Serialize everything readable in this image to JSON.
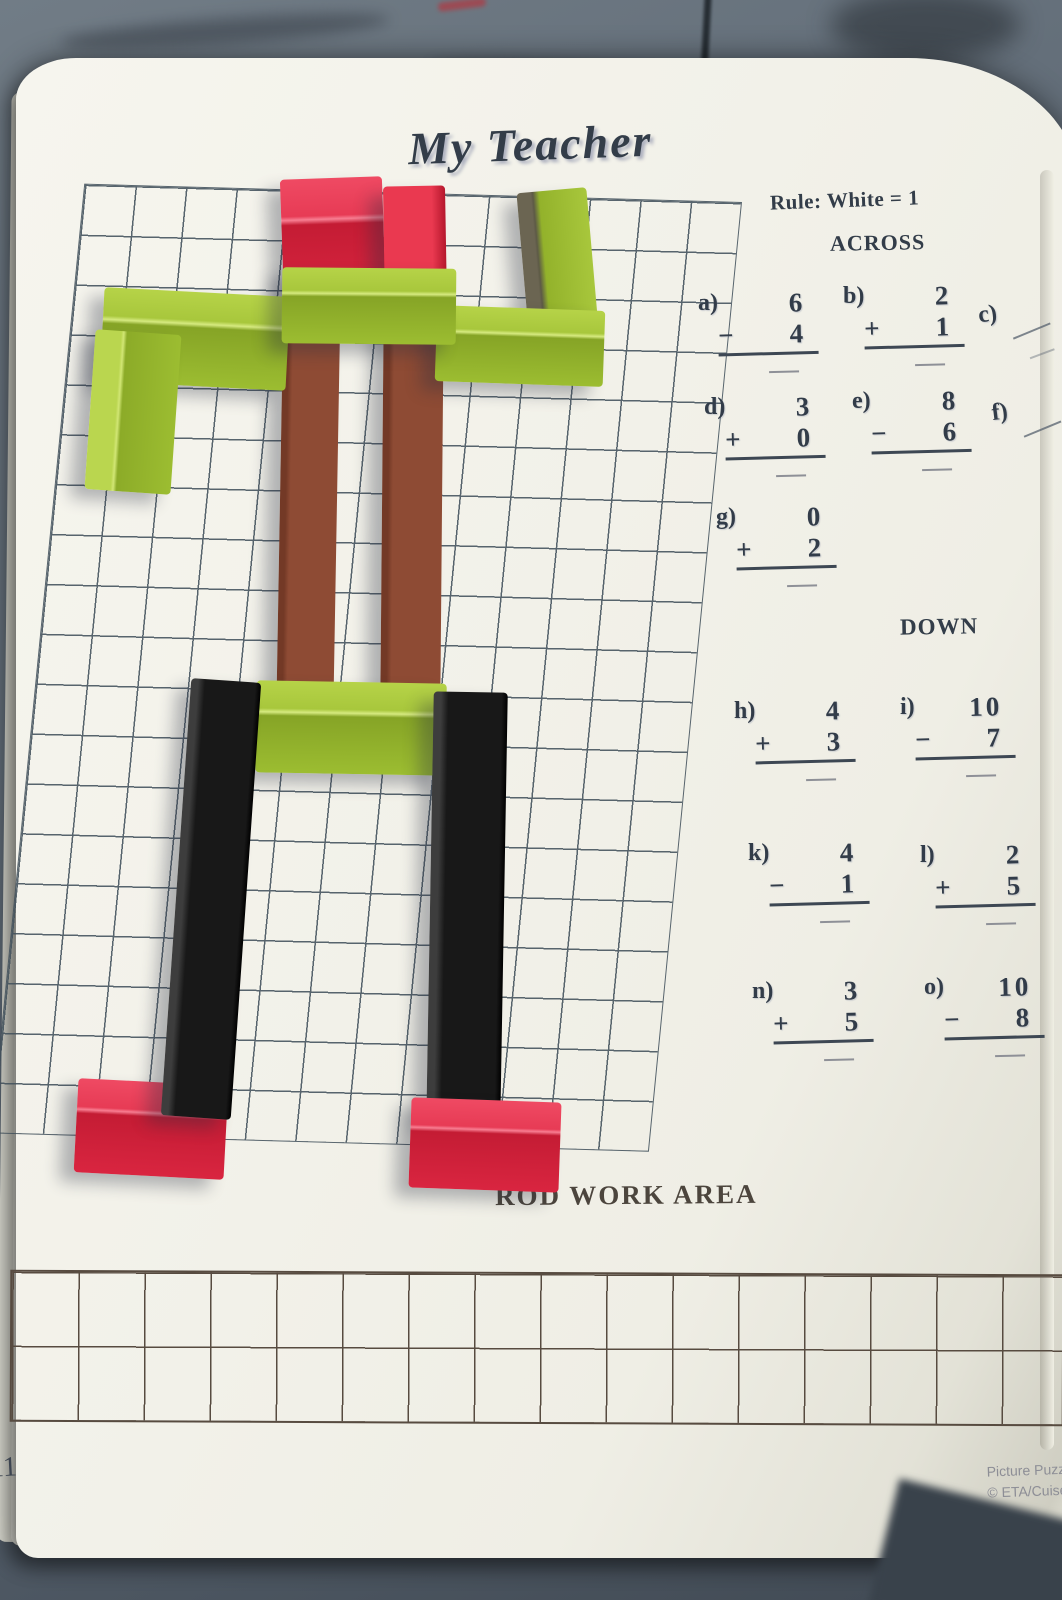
{
  "page": {
    "title": "My Teacher",
    "rule": "Rule: White = 1",
    "across_heading": "ACROSS",
    "down_heading": "DOWN",
    "rod_work_area_label": "ROD WORK AREA",
    "page_number": "11",
    "credit_line1": "Picture Puzzle",
    "credit_line2": "© ETA/Cuisen"
  },
  "problems": [
    {
      "id": "a",
      "label": "a)",
      "top": "6",
      "op": "−",
      "bottom": "4"
    },
    {
      "id": "b",
      "label": "b)",
      "top": "2",
      "op": "+",
      "bottom": "1"
    },
    {
      "id": "c",
      "label": "c)",
      "top": "",
      "op": "",
      "bottom": ""
    },
    {
      "id": "d",
      "label": "d)",
      "top": "3",
      "op": "+",
      "bottom": "0"
    },
    {
      "id": "e",
      "label": "e)",
      "top": "8",
      "op": "−",
      "bottom": "6"
    },
    {
      "id": "f",
      "label": "f)",
      "top": "",
      "op": "",
      "bottom": ""
    },
    {
      "id": "g",
      "label": "g)",
      "top": "0",
      "op": "+",
      "bottom": "2"
    },
    {
      "id": "h",
      "label": "h)",
      "top": "4",
      "op": "+",
      "bottom": "3"
    },
    {
      "id": "i",
      "label": "i)",
      "top": "10",
      "op": "−",
      "bottom": "7"
    },
    {
      "id": "k",
      "label": "k)",
      "top": "4",
      "op": "−",
      "bottom": "1"
    },
    {
      "id": "l",
      "label": "l)",
      "top": "2",
      "op": "+",
      "bottom": "5"
    },
    {
      "id": "n",
      "label": "n)",
      "top": "3",
      "op": "+",
      "bottom": "5"
    },
    {
      "id": "o",
      "label": "o)",
      "top": "10",
      "op": "−",
      "bottom": "8"
    }
  ],
  "rods": [
    {
      "name": "rod-head-red-left",
      "style": "red-top",
      "x": 282,
      "y": 178,
      "w": 102,
      "h": 124,
      "rot": -2,
      "z": 3
    },
    {
      "name": "rod-head-red-right",
      "style": "red-plain",
      "x": 384,
      "y": 186,
      "w": 62,
      "h": 118,
      "rot": -1,
      "z": 3
    },
    {
      "name": "rod-left-upper-arm-green",
      "style": "green-top",
      "x": 102,
      "y": 292,
      "w": 186,
      "h": 94,
      "rot": 3,
      "z": 4
    },
    {
      "name": "rod-left-forearm-green",
      "style": "green-leftlight",
      "x": 90,
      "y": 332,
      "w": 86,
      "h": 160,
      "rot": 4,
      "z": 4
    },
    {
      "name": "rod-right-upper-arm-green",
      "style": "green-leftdark",
      "x": 522,
      "y": 190,
      "w": 70,
      "h": 130,
      "rot": -5,
      "z": 4
    },
    {
      "name": "rod-right-forearm-green",
      "style": "green-top",
      "x": 436,
      "y": 308,
      "w": 168,
      "h": 76,
      "rot": 2,
      "z": 4
    },
    {
      "name": "rod-torso-brown-left",
      "style": "brown-vert",
      "x": 280,
      "y": 308,
      "w": 57,
      "h": 384,
      "rot": 1,
      "z": 3
    },
    {
      "name": "rod-torso-brown-right",
      "style": "brown-vert",
      "x": 382,
      "y": 314,
      "w": 60,
      "h": 388,
      "rot": 0.5,
      "z": 3
    },
    {
      "name": "rod-shoulders-green",
      "style": "green-top",
      "x": 282,
      "y": 268,
      "w": 174,
      "h": 76,
      "rot": 0.5,
      "z": 5
    },
    {
      "name": "rod-hips-green",
      "style": "green-top",
      "x": 256,
      "y": 682,
      "w": 190,
      "h": 92,
      "rot": 1,
      "z": 4
    },
    {
      "name": "rod-left-leg-black",
      "style": "black-vert",
      "x": 176,
      "y": 680,
      "w": 70,
      "h": 438,
      "rot": 4,
      "z": 5
    },
    {
      "name": "rod-right-leg-black",
      "style": "black-vert",
      "x": 430,
      "y": 692,
      "w": 74,
      "h": 432,
      "rot": 1,
      "z": 5
    },
    {
      "name": "rod-left-foot-red",
      "style": "red-top",
      "x": 76,
      "y": 1082,
      "w": 150,
      "h": 94,
      "rot": 3,
      "z": 4
    },
    {
      "name": "rod-right-foot-red",
      "style": "red-top",
      "x": 410,
      "y": 1100,
      "w": 150,
      "h": 90,
      "rot": 2,
      "z": 6
    }
  ],
  "colors": {
    "red": "#d92540",
    "green": "#9cbd31",
    "brown": "#8e4b34",
    "black": "#171717",
    "page": "#f1f0e8",
    "table": "#5a6570",
    "grid_line": "#42515c",
    "work_grid_line": "#574b40",
    "text": "#333d49",
    "credit_text": "#8d8e96"
  }
}
